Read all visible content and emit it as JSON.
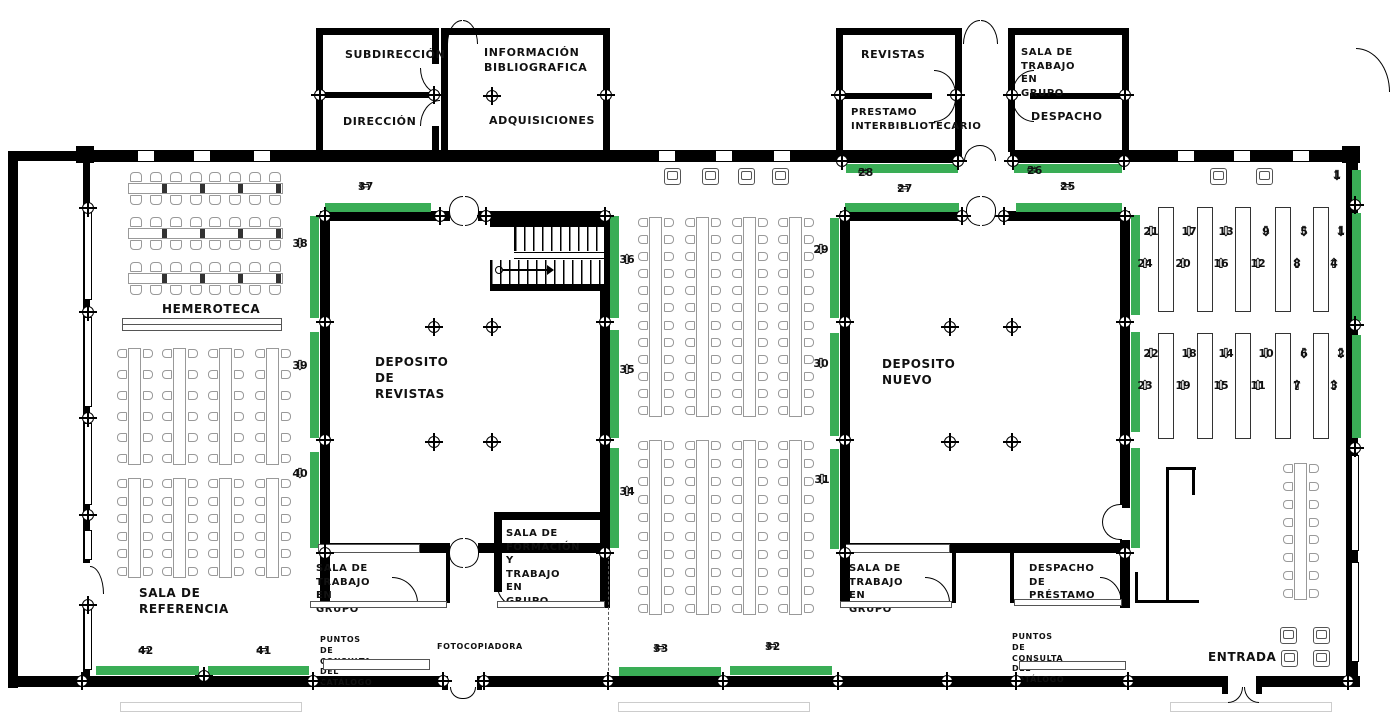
{
  "palette": {
    "green": "#3aad56",
    "wall": "#000000",
    "furniture_line": "#999999",
    "text": "#111111"
  },
  "plan": {
    "labels": [
      {
        "id": "subdireccion",
        "text": "SUBDIRECCIÓN",
        "x": 345,
        "y": 48,
        "fs": 11
      },
      {
        "id": "direccion",
        "text": "DIRECCIÓN",
        "x": 343,
        "y": 115,
        "fs": 11
      },
      {
        "id": "informacion-bibliografica",
        "text": "INFORMACIÓN\nBIBLIOGRAFICA",
        "x": 484,
        "y": 46,
        "fs": 11
      },
      {
        "id": "adquisiciones",
        "text": "ADQUISICIONES",
        "x": 489,
        "y": 114,
        "fs": 11
      },
      {
        "id": "revistas",
        "text": "REVISTAS",
        "x": 861,
        "y": 48,
        "fs": 11
      },
      {
        "id": "prestamo-interbibliotecario",
        "text": "PRESTAMO\nINTERBIBLIOTECARIO",
        "x": 851,
        "y": 106,
        "fs": 10
      },
      {
        "id": "sala-trabajo-grupo-top",
        "text": "SALA DE TRABAJO EN\nGRUPO",
        "x": 1021,
        "y": 46,
        "fs": 10
      },
      {
        "id": "despacho",
        "text": "DESPACHO",
        "x": 1031,
        "y": 110,
        "fs": 11
      },
      {
        "id": "hemeroteca",
        "text": "HEMEROTECA",
        "x": 162,
        "y": 301,
        "fs": 12
      },
      {
        "id": "deposito-revistas",
        "text": "DEPOSITO DE REVISTAS",
        "x": 375,
        "y": 354,
        "fs": 12
      },
      {
        "id": "deposito-nuevo",
        "text": "DEPOSITO NUEVO",
        "x": 882,
        "y": 356,
        "fs": 12
      },
      {
        "id": "sala-referencia",
        "text": "SALA DE REFERENCIA",
        "x": 139,
        "y": 585,
        "fs": 12
      },
      {
        "id": "sala-trabajo-grupo-bl",
        "text": "SALA DE TRABAJO\nEN GRUPO",
        "x": 316,
        "y": 562,
        "fs": 10
      },
      {
        "id": "sala-formacion",
        "text": "SALA DE\nFORMACIÓN Y\nTRABAJO EN\nGRUPO",
        "x": 506,
        "y": 527,
        "fs": 10
      },
      {
        "id": "sala-trabajo-grupo-br",
        "text": "SALA DE TRABAJO\nEN GRUPO",
        "x": 849,
        "y": 562,
        "fs": 10
      },
      {
        "id": "despacho-prestamo",
        "text": "DESPACHO DE\nPRÉSTAMO",
        "x": 1029,
        "y": 562,
        "fs": 10
      },
      {
        "id": "puntos-consulta-left",
        "text": "PUNTOS DE CONSULTA\nDEL CATÁLOGO",
        "x": 320,
        "y": 635,
        "fs": 8
      },
      {
        "id": "fotocopiadora",
        "text": "FOTOCOPIADORA",
        "x": 437,
        "y": 642,
        "fs": 8
      },
      {
        "id": "puntos-consulta-right",
        "text": "PUNTOS DE CONSULTA\nDEL CATÁLOGO",
        "x": 1012,
        "y": 632,
        "fs": 8
      },
      {
        "id": "entrada",
        "text": "ENTRADA",
        "x": 1208,
        "y": 649,
        "fs": 12
      }
    ],
    "shelf_markers": [
      {
        "n": "37",
        "layout": "h-left",
        "x": 358,
        "y": 186
      },
      {
        "n": "27",
        "layout": "h-left",
        "x": 897,
        "y": 188
      },
      {
        "n": "25",
        "layout": "h-left",
        "x": 1060,
        "y": 186
      },
      {
        "n": "28",
        "layout": "h-right",
        "x": 858,
        "y": 172
      },
      {
        "n": "26",
        "layout": "h-right",
        "x": 1027,
        "y": 170
      },
      {
        "n": "42",
        "layout": "h-left",
        "x": 138,
        "y": 650
      },
      {
        "n": "41",
        "layout": "h-left",
        "x": 256,
        "y": 650
      },
      {
        "n": "33",
        "layout": "h-left",
        "x": 653,
        "y": 648
      },
      {
        "n": "32",
        "layout": "h-left",
        "x": 765,
        "y": 646
      },
      {
        "n": "38",
        "layout": "v-down",
        "x": 292,
        "y": 238
      },
      {
        "n": "39",
        "layout": "v-down",
        "x": 292,
        "y": 360
      },
      {
        "n": "40",
        "layout": "v-down",
        "x": 292,
        "y": 468
      },
      {
        "n": "36",
        "layout": "v-up",
        "x": 619,
        "y": 254
      },
      {
        "n": "35",
        "layout": "v-up",
        "x": 619,
        "y": 364
      },
      {
        "n": "34",
        "layout": "v-up",
        "x": 619,
        "y": 486
      },
      {
        "n": "29",
        "layout": "v-down",
        "x": 813,
        "y": 244
      },
      {
        "n": "30",
        "layout": "v-down",
        "x": 813,
        "y": 358
      },
      {
        "n": "31",
        "layout": "v-down",
        "x": 814,
        "y": 474
      },
      {
        "n": "1",
        "layout": "v-down",
        "x": 1329,
        "y": 170
      },
      {
        "n": "21",
        "layout": "v-down",
        "x": 1143,
        "y": 226
      },
      {
        "n": "24",
        "layout": "v-up",
        "x": 1137,
        "y": 258
      },
      {
        "n": "17",
        "layout": "v-down",
        "x": 1181,
        "y": 226
      },
      {
        "n": "20",
        "layout": "v-up",
        "x": 1175,
        "y": 258
      },
      {
        "n": "13",
        "layout": "v-down",
        "x": 1218,
        "y": 226
      },
      {
        "n": "16",
        "layout": "v-up",
        "x": 1213,
        "y": 258
      },
      {
        "n": "9",
        "layout": "v-down",
        "x": 1258,
        "y": 226
      },
      {
        "n": "12",
        "layout": "v-up",
        "x": 1250,
        "y": 258
      },
      {
        "n": "5",
        "layout": "v-down",
        "x": 1296,
        "y": 226
      },
      {
        "n": "8",
        "layout": "v-up",
        "x": 1289,
        "y": 258
      },
      {
        "n": "1",
        "layout": "v-down",
        "x": 1333,
        "y": 226
      },
      {
        "n": "4",
        "layout": "v-up",
        "x": 1326,
        "y": 258
      },
      {
        "n": "22",
        "layout": "v-down",
        "x": 1143,
        "y": 348
      },
      {
        "n": "23",
        "layout": "v-up",
        "x": 1137,
        "y": 380
      },
      {
        "n": "18",
        "layout": "v-down",
        "x": 1181,
        "y": 348
      },
      {
        "n": "19",
        "layout": "v-up",
        "x": 1175,
        "y": 380
      },
      {
        "n": "14",
        "layout": "v-down",
        "x": 1218,
        "y": 348
      },
      {
        "n": "15",
        "layout": "v-up",
        "x": 1213,
        "y": 380
      },
      {
        "n": "10",
        "layout": "v-down",
        "x": 1258,
        "y": 348
      },
      {
        "n": "11",
        "layout": "v-up",
        "x": 1250,
        "y": 380
      },
      {
        "n": "6",
        "layout": "v-down",
        "x": 1296,
        "y": 348
      },
      {
        "n": "7",
        "layout": "v-up",
        "x": 1289,
        "y": 380
      },
      {
        "n": "2",
        "layout": "v-down",
        "x": 1333,
        "y": 348
      },
      {
        "n": "3",
        "layout": "v-up",
        "x": 1326,
        "y": 380
      }
    ],
    "strips_h": [
      {
        "x": 325,
        "y": 203,
        "w": 106
      },
      {
        "x": 845,
        "y": 203,
        "w": 114
      },
      {
        "x": 1016,
        "y": 203,
        "w": 106
      },
      {
        "x": 846,
        "y": 164,
        "w": 112
      },
      {
        "x": 1014,
        "y": 164,
        "w": 108
      },
      {
        "x": 96,
        "y": 666,
        "w": 103
      },
      {
        "x": 208,
        "y": 666,
        "w": 101
      },
      {
        "x": 619,
        "y": 667,
        "w": 102
      },
      {
        "x": 730,
        "y": 666,
        "w": 102
      }
    ],
    "strips_v": [
      {
        "x": 310,
        "y": 216,
        "h": 102
      },
      {
        "x": 310,
        "y": 332,
        "h": 106
      },
      {
        "x": 310,
        "y": 452,
        "h": 96
      },
      {
        "x": 610,
        "y": 216,
        "h": 102
      },
      {
        "x": 610,
        "y": 330,
        "h": 108
      },
      {
        "x": 610,
        "y": 448,
        "h": 100
      },
      {
        "x": 830,
        "y": 218,
        "h": 100
      },
      {
        "x": 830,
        "y": 333,
        "h": 103
      },
      {
        "x": 830,
        "y": 449,
        "h": 100
      },
      {
        "x": 1131,
        "y": 215,
        "h": 100
      },
      {
        "x": 1131,
        "y": 332,
        "h": 100
      },
      {
        "x": 1131,
        "y": 448,
        "h": 100
      },
      {
        "x": 1352,
        "y": 170,
        "h": 36
      },
      {
        "x": 1352,
        "y": 213,
        "h": 108
      },
      {
        "x": 1352,
        "y": 335,
        "h": 103
      }
    ],
    "shelf_rows": [
      {
        "y": 207,
        "h": 105,
        "xs": [
          1158,
          1197,
          1235,
          1275,
          1313
        ]
      },
      {
        "y": 333,
        "h": 106,
        "xs": [
          1158,
          1197,
          1235,
          1275,
          1313
        ]
      }
    ],
    "windows": {
      "top": [
        137,
        193,
        253,
        658,
        715,
        773,
        1177,
        1233,
        1292
      ],
      "left": [
        {
          "y": 212,
          "h": 88
        },
        {
          "y": 317,
          "h": 90
        },
        {
          "y": 423,
          "h": 82
        },
        {
          "y": 530,
          "h": 30
        },
        {
          "y": 606,
          "h": 64
        }
      ],
      "right": [
        {
          "y": 455,
          "h": 96
        },
        {
          "y": 562,
          "h": 100
        }
      ]
    },
    "colmarks": [
      [
        88,
        208
      ],
      [
        88,
        312
      ],
      [
        88,
        418
      ],
      [
        88,
        515
      ],
      [
        88,
        605
      ],
      [
        82,
        681
      ],
      [
        204,
        676
      ],
      [
        313,
        681
      ],
      [
        443,
        681
      ],
      [
        484,
        681
      ],
      [
        608,
        681
      ],
      [
        723,
        681
      ],
      [
        838,
        681
      ],
      [
        947,
        681
      ],
      [
        1016,
        681
      ],
      [
        1128,
        681
      ],
      [
        1348,
        681
      ],
      [
        320,
        95
      ],
      [
        434,
        95
      ],
      [
        492,
        96
      ],
      [
        606,
        95
      ],
      [
        840,
        95
      ],
      [
        956,
        95
      ],
      [
        1012,
        95
      ],
      [
        1125,
        95
      ],
      [
        842,
        161
      ],
      [
        958,
        161
      ],
      [
        1013,
        161
      ],
      [
        1124,
        161
      ],
      [
        325,
        216
      ],
      [
        440,
        216
      ],
      [
        486,
        216
      ],
      [
        605,
        216
      ],
      [
        845,
        216
      ],
      [
        962,
        216
      ],
      [
        1004,
        216
      ],
      [
        1125,
        216
      ],
      [
        1355,
        205
      ],
      [
        325,
        322
      ],
      [
        325,
        440
      ],
      [
        325,
        553
      ],
      [
        605,
        322
      ],
      [
        605,
        440
      ],
      [
        605,
        553
      ],
      [
        845,
        322
      ],
      [
        845,
        440
      ],
      [
        845,
        553
      ],
      [
        1125,
        322
      ],
      [
        1125,
        440
      ],
      [
        1125,
        553
      ],
      [
        1355,
        325
      ],
      [
        1355,
        448
      ],
      [
        434,
        327
      ],
      [
        492,
        327
      ],
      [
        434,
        442
      ],
      [
        492,
        442
      ],
      [
        950,
        327
      ],
      [
        1012,
        327
      ],
      [
        950,
        442
      ],
      [
        1012,
        442
      ]
    ],
    "furniture": {
      "htables": [
        {
          "x": 128,
          "y": 172,
          "w": 155,
          "chairs": 8
        },
        {
          "x": 128,
          "y": 217,
          "w": 155,
          "chairs": 8
        },
        {
          "x": 128,
          "y": 262,
          "w": 155,
          "chairs": 8
        }
      ],
      "vtables": [
        {
          "x": 117,
          "y": 348,
          "h": 117,
          "pairs": 6
        },
        {
          "x": 162,
          "y": 348,
          "h": 117,
          "pairs": 6
        },
        {
          "x": 208,
          "y": 348,
          "h": 117,
          "pairs": 6
        },
        {
          "x": 255,
          "y": 348,
          "h": 117,
          "pairs": 6
        },
        {
          "x": 117,
          "y": 478,
          "h": 100,
          "pairs": 6
        },
        {
          "x": 162,
          "y": 478,
          "h": 100,
          "pairs": 6
        },
        {
          "x": 208,
          "y": 478,
          "h": 100,
          "pairs": 6
        },
        {
          "x": 255,
          "y": 478,
          "h": 100,
          "pairs": 6
        },
        {
          "x": 638,
          "y": 217,
          "h": 200,
          "pairs": 12
        },
        {
          "x": 685,
          "y": 217,
          "h": 200,
          "pairs": 12
        },
        {
          "x": 732,
          "y": 217,
          "h": 200,
          "pairs": 12
        },
        {
          "x": 778,
          "y": 217,
          "h": 200,
          "pairs": 12
        },
        {
          "x": 638,
          "y": 440,
          "h": 175,
          "pairs": 10
        },
        {
          "x": 685,
          "y": 440,
          "h": 175,
          "pairs": 10
        },
        {
          "x": 732,
          "y": 440,
          "h": 175,
          "pairs": 10
        },
        {
          "x": 778,
          "y": 440,
          "h": 175,
          "pairs": 10
        },
        {
          "x": 1283,
          "y": 463,
          "h": 137,
          "pairs": 8
        }
      ],
      "armchairs": [
        {
          "x": 664,
          "y": 168
        },
        {
          "x": 702,
          "y": 168
        },
        {
          "x": 738,
          "y": 168
        },
        {
          "x": 772,
          "y": 168
        },
        {
          "x": 1210,
          "y": 168
        },
        {
          "x": 1256,
          "y": 168
        },
        {
          "x": 1280,
          "y": 627
        },
        {
          "x": 1313,
          "y": 627
        },
        {
          "x": 1281,
          "y": 650
        },
        {
          "x": 1313,
          "y": 650
        }
      ],
      "counters": [
        {
          "x": 122,
          "y": 318,
          "w": 160,
          "h": 13,
          "shelf": true
        },
        {
          "x": 323,
          "y": 659,
          "w": 107,
          "h": 11
        },
        {
          "x": 1019,
          "y": 661,
          "w": 107,
          "h": 9
        },
        {
          "x": 318,
          "y": 544,
          "w": 102,
          "h": 9
        },
        {
          "x": 845,
          "y": 544,
          "w": 105,
          "h": 9
        },
        {
          "x": 310,
          "y": 601,
          "w": 137,
          "h": 7
        },
        {
          "x": 497,
          "y": 601,
          "w": 108,
          "h": 7
        },
        {
          "x": 840,
          "y": 601,
          "w": 112,
          "h": 7
        },
        {
          "x": 1014,
          "y": 599,
          "w": 108,
          "h": 7
        }
      ]
    }
  }
}
